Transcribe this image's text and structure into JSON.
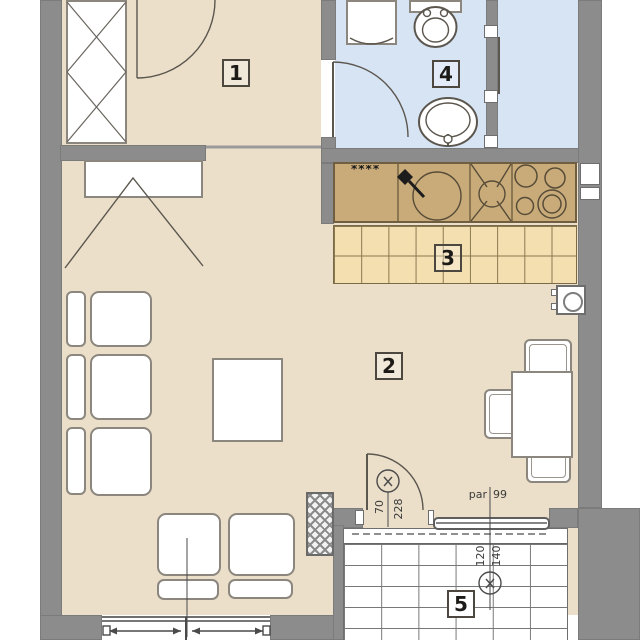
{
  "plan": {
    "labels": {
      "room1": "1",
      "room2": "2",
      "room3": "3",
      "room4": "4",
      "room5": "5"
    },
    "annotations": {
      "balcony_door_width": "70",
      "balcony_door_height": "228",
      "window_width": "120",
      "window_height": "140",
      "parapet_label": "par",
      "parapet_height": "99",
      "dishwasher_marks": "****"
    },
    "colors": {
      "wall": "#8c8c8c",
      "floor_main": "#ebdfca",
      "floor_bath": "#d7e4f4",
      "counter": "#c9ab7a",
      "floor_kitchen": "#f3dfb0"
    },
    "icons": {
      "window_type_marker": "x-in-circle",
      "shaft_symbol": "cross-hatch-column",
      "vent_symbol": "circle-in-square"
    }
  }
}
